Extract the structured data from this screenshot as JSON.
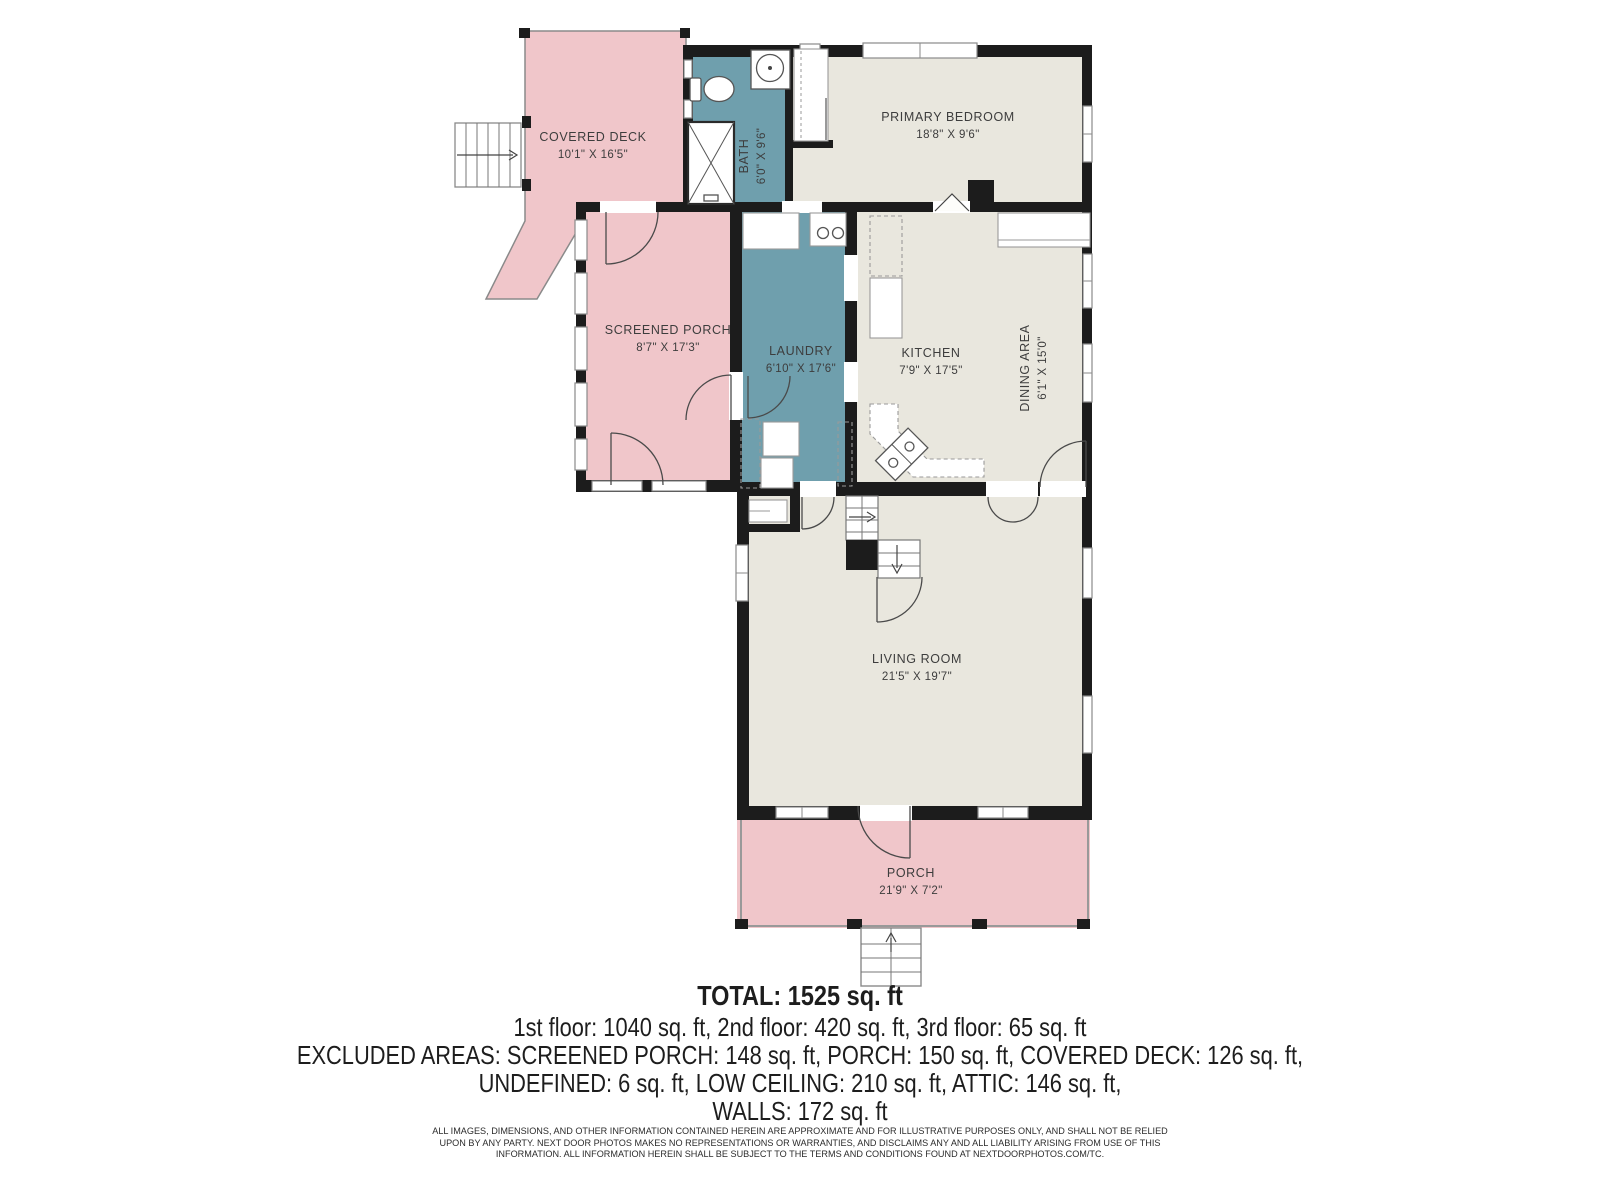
{
  "floor_plan": {
    "rooms": {
      "covered_deck": {
        "name": "COVERED DECK",
        "dims": "10'1\" X 16'5\""
      },
      "bath": {
        "name": "BATH",
        "dims": "6'0\" X 9'6\""
      },
      "primary_bedroom": {
        "name": "PRIMARY BEDROOM",
        "dims": "18'8\" X 9'6\""
      },
      "screened_porch": {
        "name": "SCREENED PORCH",
        "dims": "8'7\" X 17'3\""
      },
      "laundry": {
        "name": "LAUNDRY",
        "dims": "6'10\" X 17'6\""
      },
      "kitchen": {
        "name": "KITCHEN",
        "dims": "7'9\" X 17'5\""
      },
      "dining_area": {
        "name": "DINING AREA",
        "dims": "6'1\" X 15'0\""
      },
      "living_room": {
        "name": "LIVING ROOM",
        "dims": "21'5\" X 19'7\""
      },
      "porch": {
        "name": "PORCH",
        "dims": "21'9\" X 7'2\""
      }
    },
    "colors": {
      "room_pink": "#f0c6ca",
      "room_teal": "#6f9fad",
      "room_beige": "#e9e7de",
      "wall_dark": "#1c1c1c"
    }
  },
  "summary": {
    "total": "TOTAL: 1525 sq. ft",
    "floors_line": "1st floor: 1040 sq. ft, 2nd floor: 420 sq. ft, 3rd floor: 65 sq. ft",
    "excluded_line1": "EXCLUDED AREAS: SCREENED PORCH: 148 sq. ft, PORCH: 150 sq. ft, COVERED DECK: 126 sq. ft,",
    "excluded_line2": "UNDEFINED: 6 sq. ft, LOW CEILING: 210 sq. ft, ATTIC: 146 sq. ft,",
    "excluded_line3": "WALLS: 172 sq. ft",
    "disclaimer": "ALL IMAGES, DIMENSIONS, AND OTHER INFORMATION CONTAINED HEREIN ARE APPROXIMATE AND FOR ILLUSTRATIVE PURPOSES ONLY, AND SHALL NOT BE RELIED UPON BY ANY PARTY. NEXT DOOR PHOTOS MAKES NO REPRESENTATIONS OR WARRANTIES, AND DISCLAIMS ANY AND ALL LIABILITY ARISING FROM USE OF THIS INFORMATION. ALL INFORMATION HEREIN SHALL BE SUBJECT TO THE TERMS AND CONDITIONS FOUND AT NEXTDOORPHOTOS.COM/TC."
  }
}
